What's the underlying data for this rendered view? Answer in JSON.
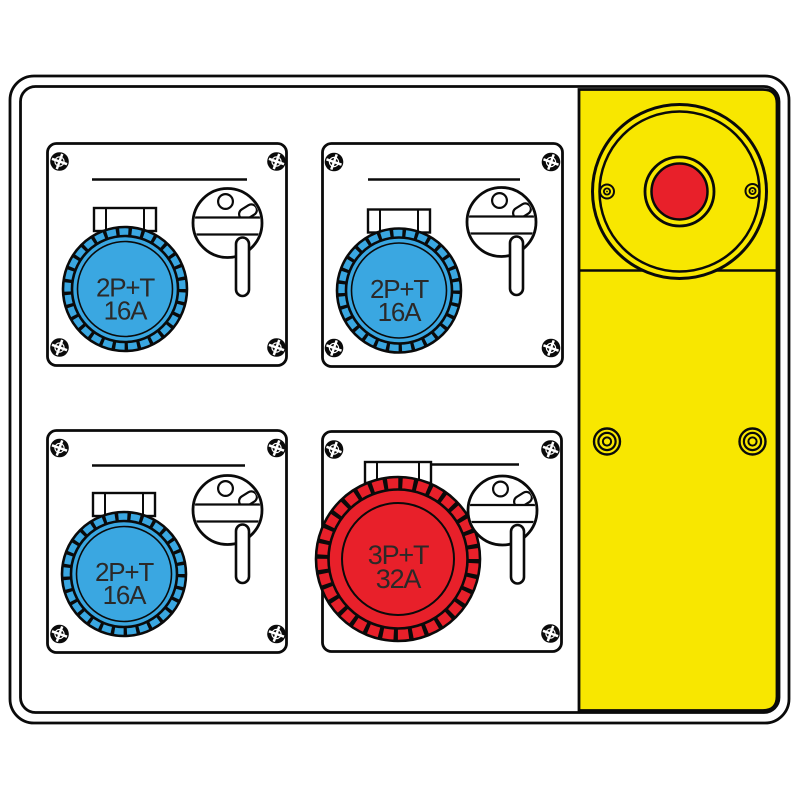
{
  "board": {
    "background_color": "#ffffff",
    "outline_color": "#0a0a0a",
    "label_text_color": "#2b2928"
  },
  "emergency_stop": {
    "panel_color": "#f8e700",
    "button_color": "#e8202a"
  },
  "sockets": [
    {
      "position": "top-left",
      "type": "2P+T",
      "rating": "16A",
      "color": "#3aa7e1"
    },
    {
      "position": "top-right",
      "type": "2P+T",
      "rating": "16A",
      "color": "#3aa7e1"
    },
    {
      "position": "bottom-left",
      "type": "2P+T",
      "rating": "16A",
      "color": "#3aa7e1"
    },
    {
      "position": "bottom-right",
      "type": "3P+T",
      "rating": "32A",
      "color": "#e8202a"
    }
  ]
}
